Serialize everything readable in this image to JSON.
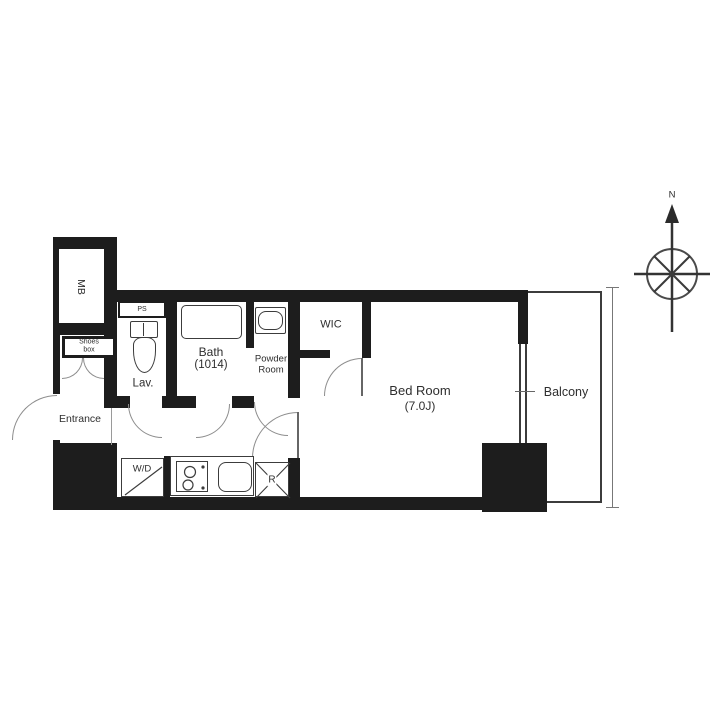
{
  "plan": {
    "rooms": {
      "mb": "MB",
      "ps": "PS",
      "shoes_box": {
        "line1": "Shoes",
        "line2": "box"
      },
      "lav": "Lav.",
      "bath": {
        "line1": "Bath",
        "line2": "(1014)"
      },
      "powder": {
        "line1": "Powder",
        "line2": "Room"
      },
      "wic": "WIC",
      "bedroom": {
        "line1": "Bed Room",
        "line2": "(7.0J)"
      },
      "balcony": "Balcony",
      "entrance": "Entrance"
    },
    "fixtures": {
      "washer_dryer": "W/D",
      "refrigerator": "R"
    },
    "compass": {
      "north": "N"
    },
    "colors": {
      "wall": "#1d1d1d",
      "fixture_line": "#3c3c3c",
      "door_arc": "#8d8d8d",
      "text": "#2e2e2e"
    }
  }
}
